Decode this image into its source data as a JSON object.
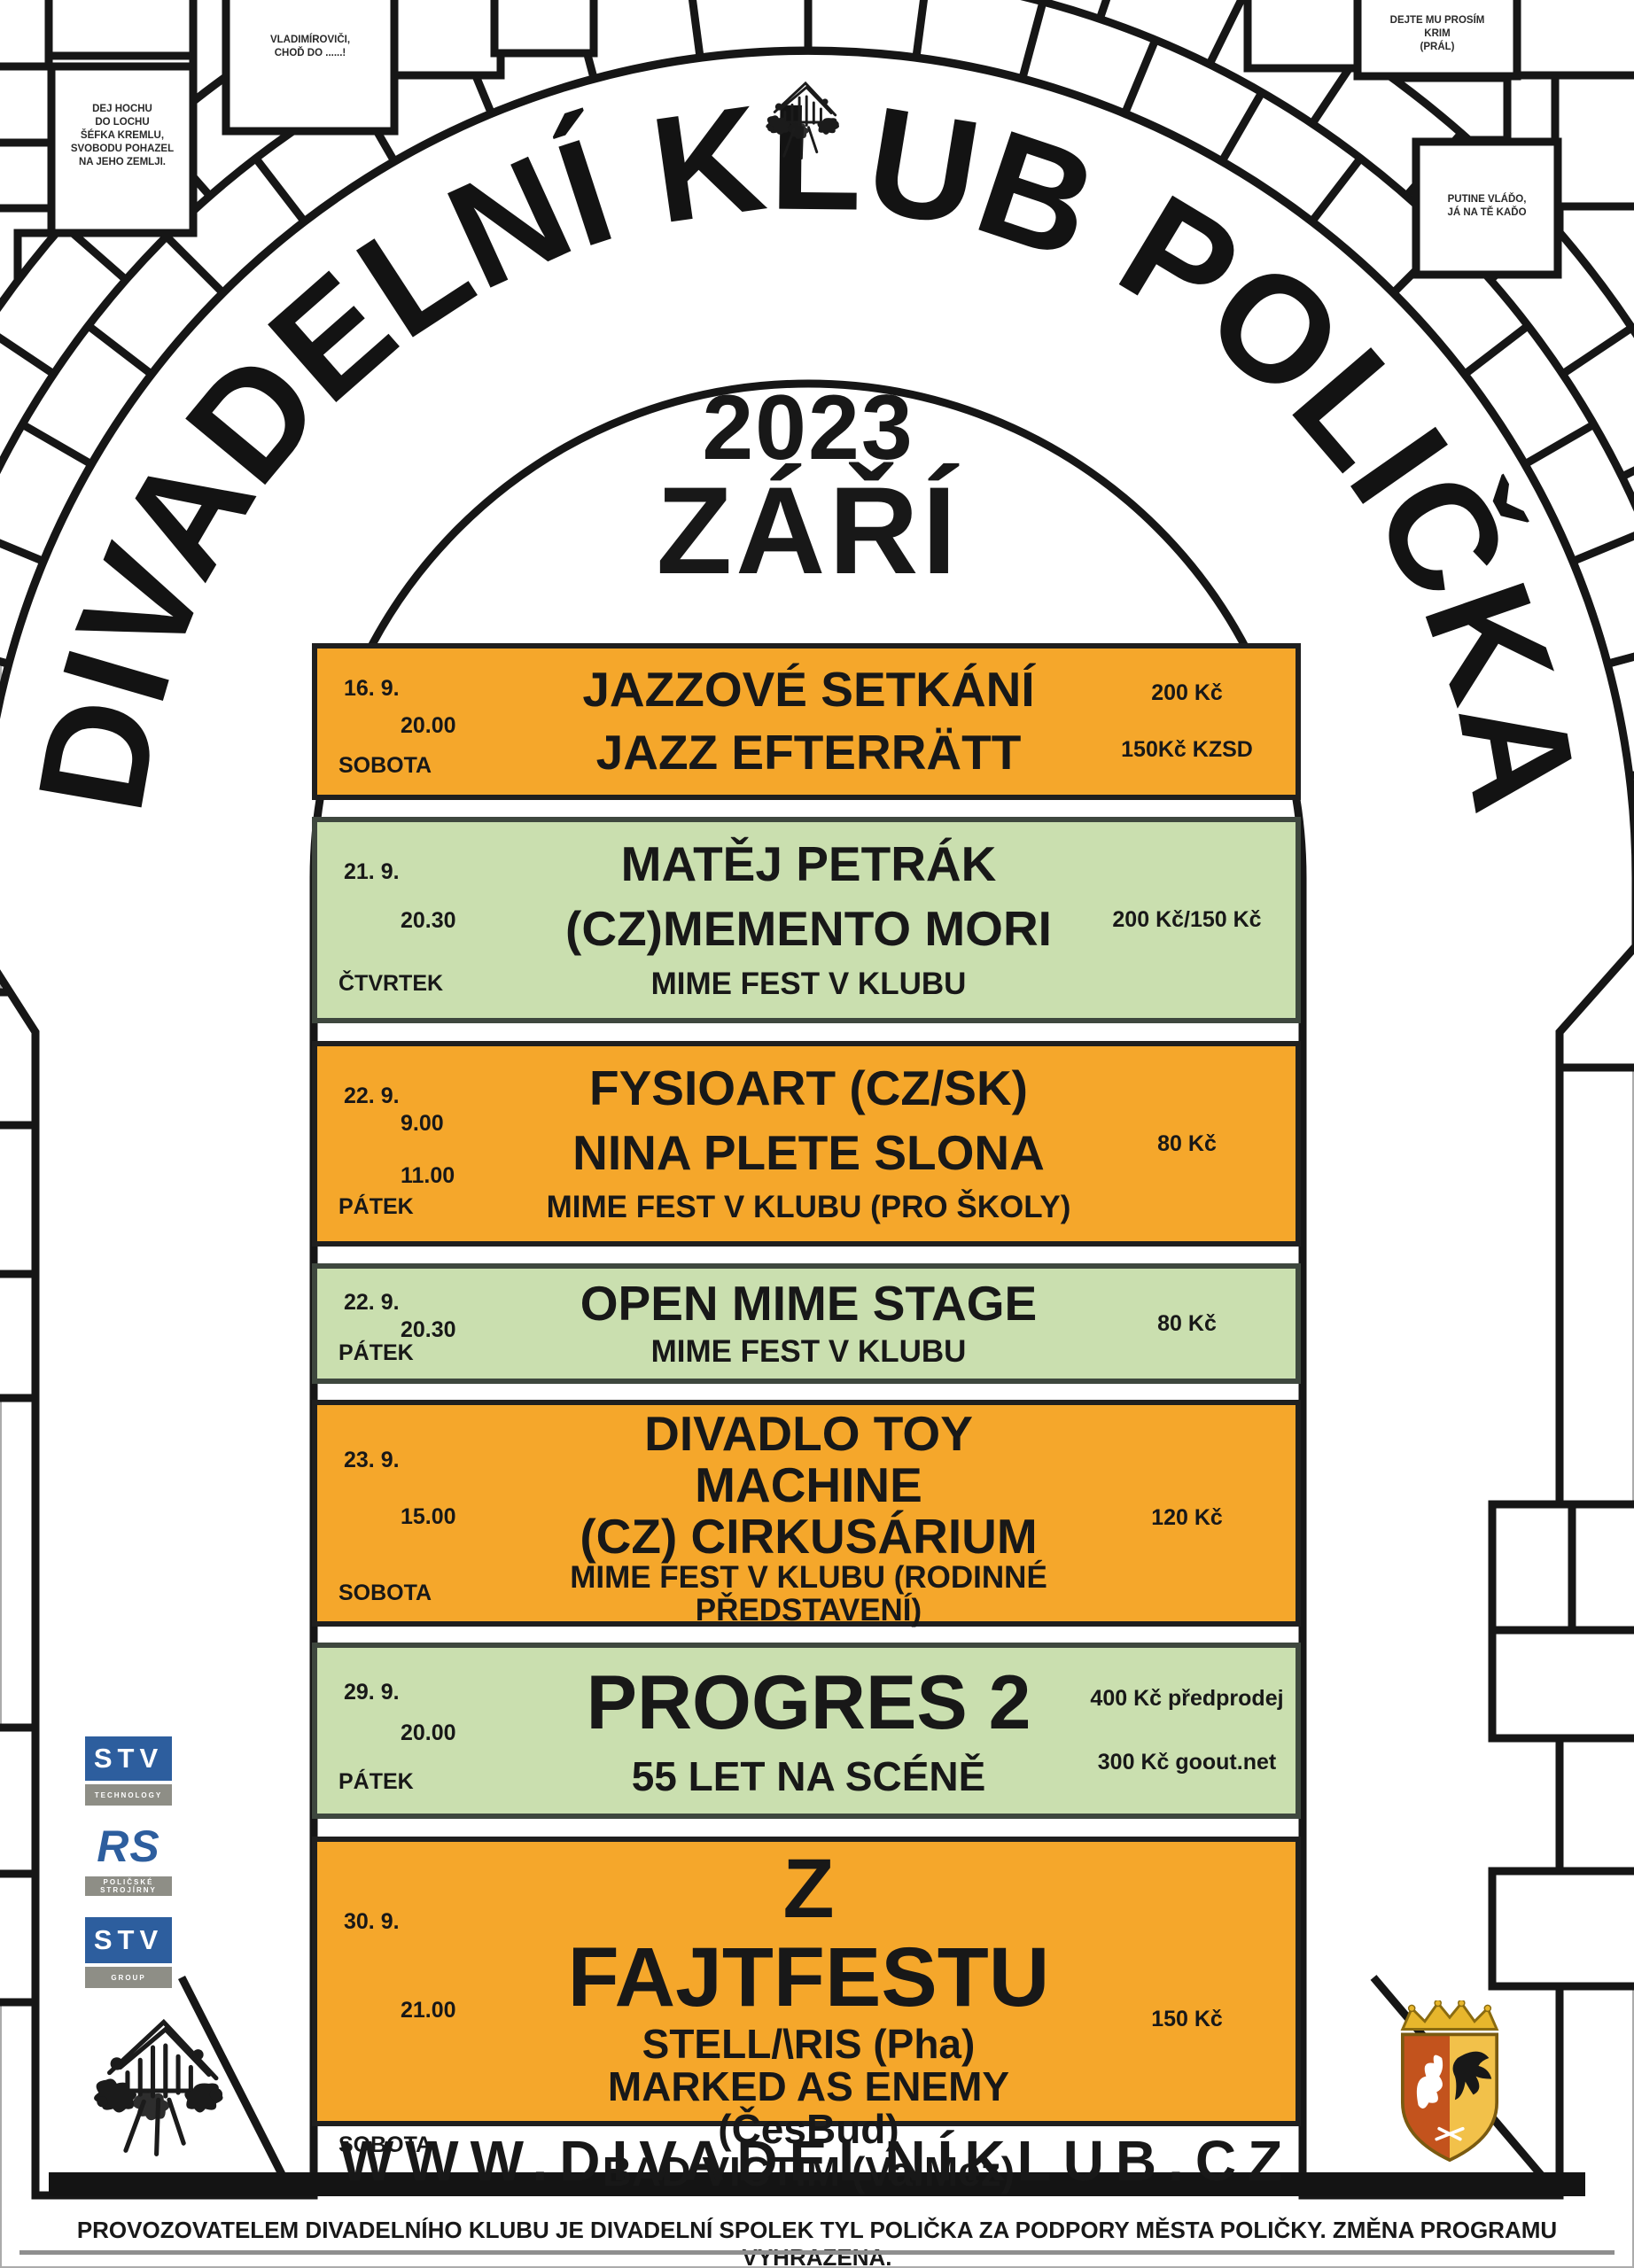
{
  "poster": {
    "arch_title": "DIVADELNÍ KLUB POLIČKA",
    "year": "2023",
    "month": "ZÁŘÍ",
    "website": "WWW.DIVADELNÍKLUB.CZ",
    "footer": "PROVOZOVATELEM DIVADELNÍHO KLUBU JE DIVADELNÍ SPOLEK TYL POLIČKA ZA PODPORY MĚSTA POLIČKY. ZMĚNA PROGRAMU VYHRAZENA.",
    "colors": {
      "orange": "#F5A72B",
      "green": "#CADFAF",
      "logo_blue": "#2D5E9E"
    }
  },
  "graffiti": {
    "left_brick": [
      "DEJ HOCHU",
      "DO LOCHU",
      "ŠÉFKA KREMLU,",
      "SVOBODU POHAZEL",
      "NA JEHO ZEMLJI."
    ],
    "top_brick": [
      "VLADIMÍROVIČI,",
      "CHOĎ DO ......!"
    ],
    "top_right_brick": [
      "DEJTE MU PROSÍM",
      "KRIM",
      "(PRÁL)"
    ],
    "right_brick": [
      "PUTINE VLÁĎO,",
      "JÁ NA TĚ KAĎO"
    ]
  },
  "logos": {
    "stv": "STV",
    "stv_technology_sub": "TECHNOLOGY",
    "rs": "RS",
    "rs_sub": "POLIČSKÉ STROJÍRNY",
    "stv_group_sub": "GROUP"
  },
  "events": [
    {
      "date": "16. 9.",
      "time": "20.00",
      "day": "SOBOTA",
      "lines": [
        "JAZZOVÉ SETKÁNÍ",
        "JAZZ EFTERRÄTT"
      ],
      "price1": "200 Kč",
      "price2": "150Kč KZSD"
    },
    {
      "date": "21. 9.",
      "time": "20.30",
      "day": "ČTVRTEK",
      "lines": [
        "MATĚJ PETRÁK",
        "(CZ)MEMENTO MORI",
        "MIME FEST V KLUBU"
      ],
      "price1": "200 Kč/150 Kč"
    },
    {
      "date": "22. 9.",
      "time": "9.00",
      "time2": "11.00",
      "day": "PÁTEK",
      "lines": [
        "FYSIOART (CZ/SK)",
        "NINA PLETE SLONA",
        "MIME FEST V KLUBU  (PRO ŠKOLY)"
      ],
      "price1": "80 Kč"
    },
    {
      "date": "22. 9.",
      "time": "20.30",
      "day": "PÁTEK",
      "lines": [
        "OPEN MIME STAGE",
        "MIME FEST V KLUBU"
      ],
      "price1": "80 Kč"
    },
    {
      "date": "23. 9.",
      "time": "15.00",
      "day": "SOBOTA",
      "lines": [
        "DIVADLO TOY MACHINE",
        "(CZ) CIRKUSÁRIUM",
        "MIME FEST V KLUBU (RODINNÉ PŘEDSTAVENÍ)"
      ],
      "price1": "120 Kč"
    },
    {
      "date": "29. 9.",
      "time": "20.00",
      "day": "PÁTEK",
      "lines": [
        "PROGRES 2",
        "55 LET NA SCÉNĚ"
      ],
      "price1": "400 Kč předprodej",
      "price2": "300 Kč goout.net"
    },
    {
      "date": "30. 9.",
      "time": "21.00",
      "day": "SOBOTA",
      "lines": [
        "Z FAJTFESTU",
        "STELL/\\RIS (Pha)",
        "MARKED AS ENEMY (ČesBud)",
        "BAD VICTIM (ValMez)"
      ],
      "price1": "150 Kč"
    }
  ]
}
